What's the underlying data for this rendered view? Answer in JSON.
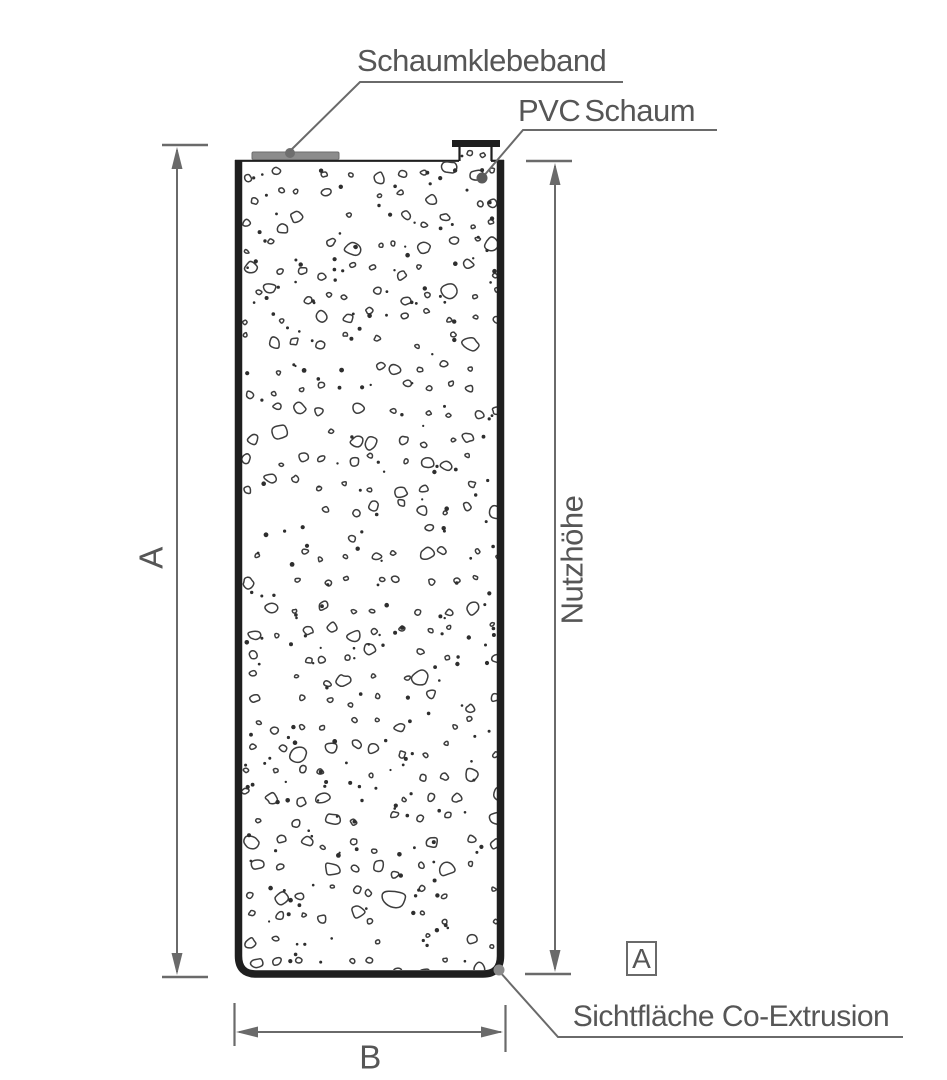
{
  "diagram": {
    "title_context": "profile-cross-section",
    "labels": {
      "schaumklebeband": "Schaumklebeband",
      "pvc_schaum": "PVC Schaum",
      "nutzhoehe": "Nutzhöhe",
      "dim_a": "A",
      "dim_b": "B",
      "sichtflaeche": "Sichtfläche Co-Extrusion",
      "section_marker": "A"
    },
    "colors": {
      "background": "#ffffff",
      "outline": "#1f1f1f",
      "dimension": "#6a6a6a",
      "text": "#565656",
      "tape": "#8c8c8c",
      "tape_dot": "#6e6e6e",
      "leader_dot": "#5a5a5a",
      "corner_dot": "#8a8a8a",
      "pebble_stroke": "#3d3d3d",
      "dot_fill": "#2e2e2e"
    }
  }
}
